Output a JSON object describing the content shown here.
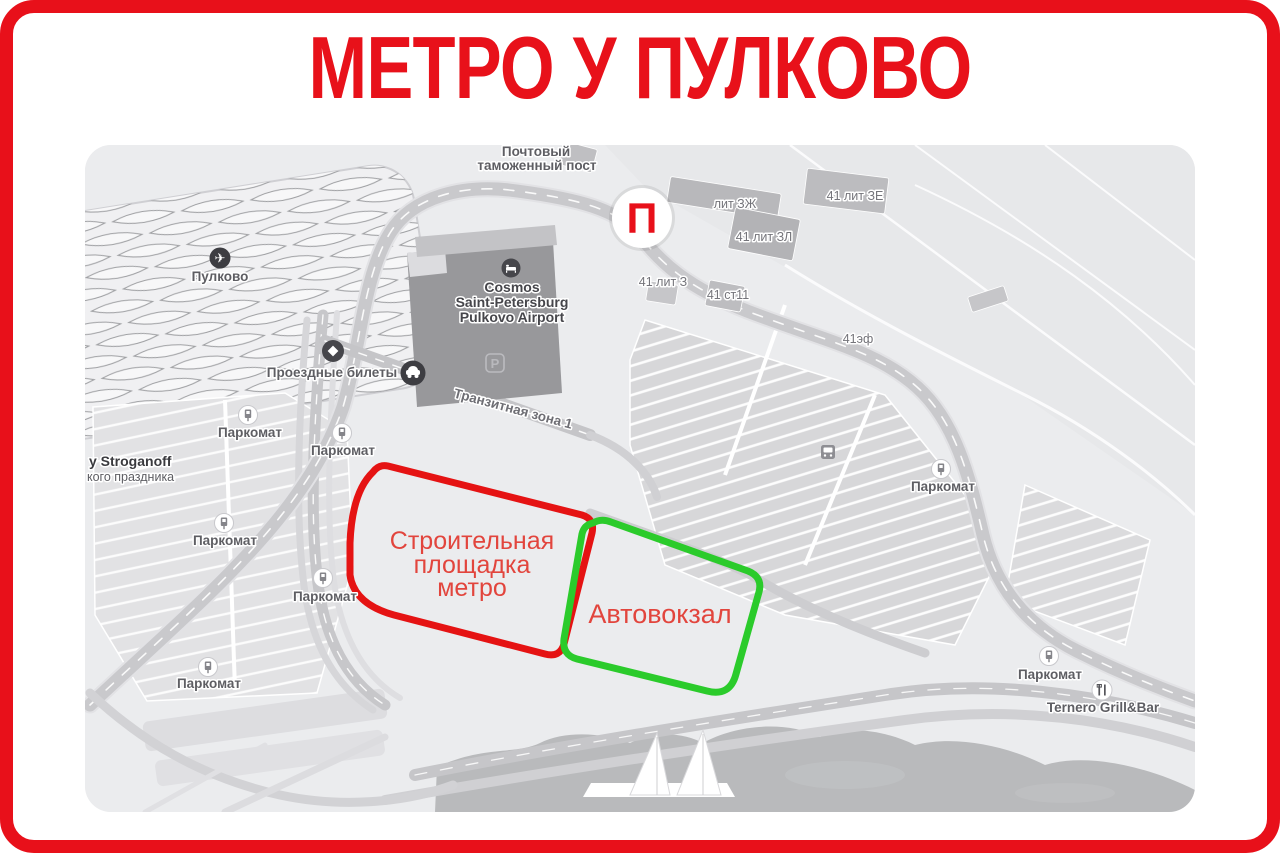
{
  "poster": {
    "title": "МЕТРО У ПУЛКОВО"
  },
  "colors": {
    "accent_red": "#e8111a",
    "construction_outline": "#e51313",
    "bus_station_outline": "#2bcb2b",
    "area_label_red": "#e2453d"
  },
  "map": {
    "marker": {
      "letter": "П"
    },
    "areas": {
      "construction": {
        "line1": "Строительная",
        "line2": "площадка",
        "line3": "метро"
      },
      "bus_station": {
        "label": "Автовокзал"
      }
    },
    "labels": {
      "airport": "Пулково",
      "hotel_line1": "Cosmos",
      "hotel_line2": "Saint-Petersburg",
      "hotel_line3": "Pulkovo Airport",
      "customs_line1": "Почтовый",
      "customs_line2": "таможенный пост",
      "tickets": "Проездные билеты",
      "transit_zone": "Транзитная зона 1",
      "parkomat": "Паркомат",
      "stroganoff_line1": "y Stroganoff",
      "stroganoff_line2": "кого праздника",
      "bldg_41_lit_ze": "41 лит ЗЕ",
      "bldg_41_lit_zl": "41 лит ЗЛ",
      "bldg_lit_zzh": "лит ЗЖ",
      "bldg_41_lit_z": "41 лит З",
      "bldg_41_st11": "41 ст11",
      "bldg_41_ef": "41эф",
      "restaurant": "Ternero Grill&Bar",
      "parking_letter": "P"
    },
    "icons": {
      "airplane": "✈"
    }
  }
}
